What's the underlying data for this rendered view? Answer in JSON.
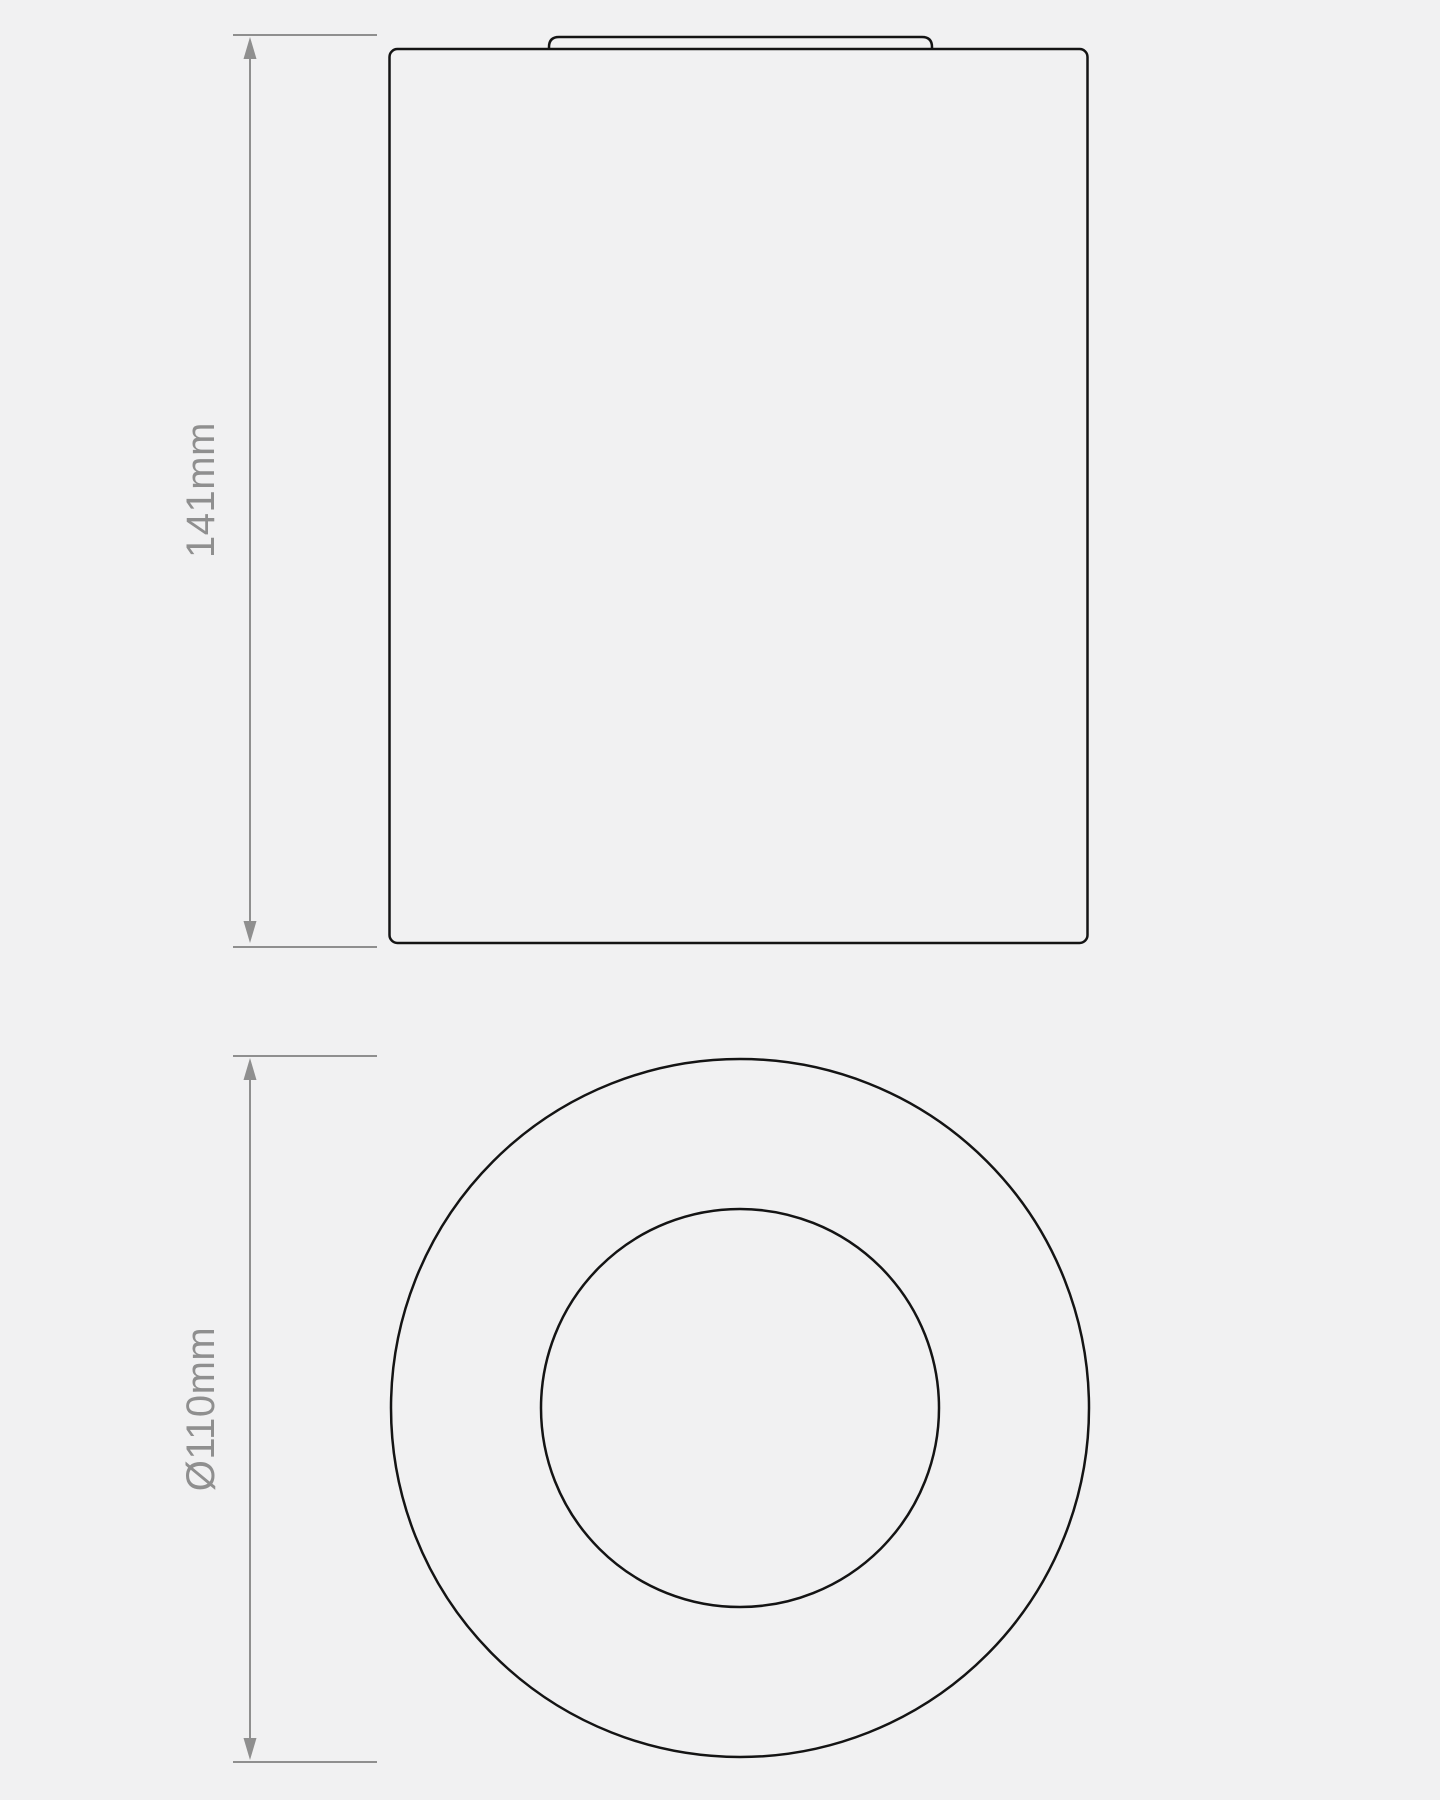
{
  "drawing": {
    "kind": "technical-dimension-drawing",
    "colors": {
      "background": "#f1f1f2",
      "outline": "#141414",
      "dimension": "#8f8f8f"
    },
    "views": {
      "side": {
        "height_label": "141mm"
      },
      "plan": {
        "diameter_label": "Ø110mm"
      }
    }
  }
}
